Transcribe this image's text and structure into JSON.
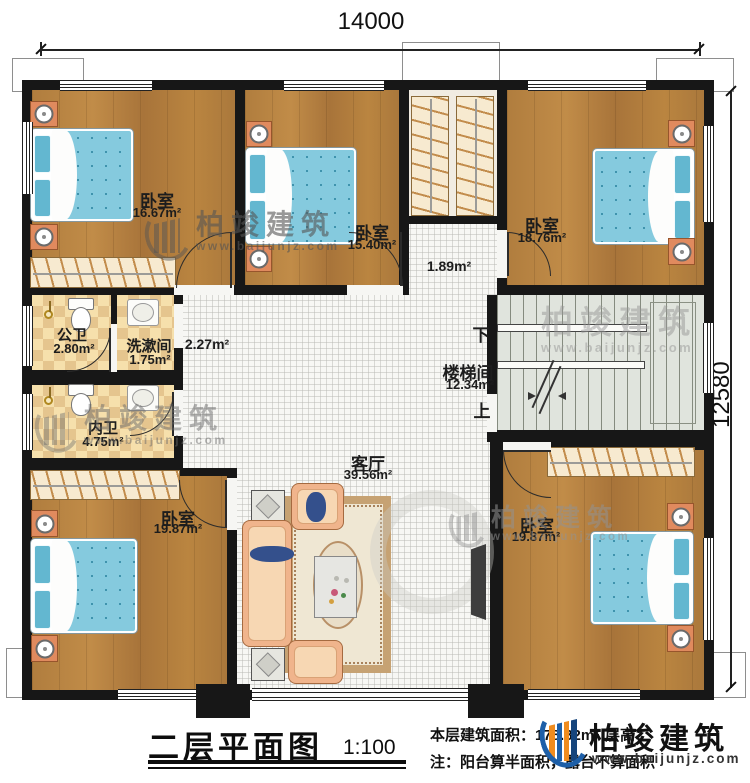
{
  "dimensions": {
    "width_top": "14000",
    "height_right": "12580"
  },
  "rooms": {
    "bedroom_tl": {
      "name": "卧室",
      "area": "16.67m²"
    },
    "bedroom_tm": {
      "name": "卧室",
      "area": "15.40m²"
    },
    "bedroom_tr": {
      "name": "卧室",
      "area": "18.76m²"
    },
    "passage": {
      "area": "1.89m²"
    },
    "public_bath": {
      "name": "公卫",
      "area": "2.80m²"
    },
    "washroom": {
      "name": "洗漱间",
      "area": "1.75m²"
    },
    "corridor": {
      "area": "2.27m²"
    },
    "private_bath": {
      "name": "内卫",
      "area": "4.75m²"
    },
    "stairwell": {
      "name": "楼梯间",
      "area": "12.34m²",
      "down": "下",
      "up": "上"
    },
    "bedroom_bl": {
      "name": "卧室",
      "area": "19.87m²"
    },
    "living": {
      "name": "客厅",
      "area": "39.56m²"
    },
    "bedroom_br": {
      "name": "卧室",
      "area": "19.87m²"
    }
  },
  "title_block": {
    "title": "二层平面图",
    "scale": "1:100",
    "area_text": "本层建筑面积：178.82m²",
    "height_text": "层高：",
    "note": "注：阳台算半面积，露台不算面积"
  },
  "brand": {
    "name": "柏竣建筑",
    "url": "www.baijunjz.com"
  },
  "watermark": {
    "name": "柏竣建筑",
    "url": "www.baijunjz.com"
  }
}
